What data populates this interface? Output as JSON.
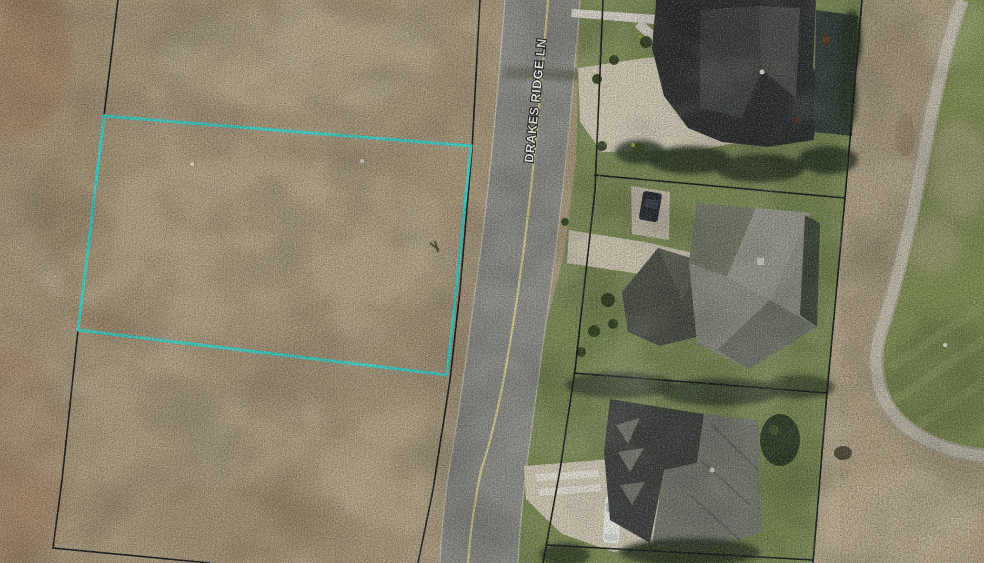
{
  "map": {
    "type": "aerial-parcel-imagery",
    "road_label": "DRAKES RIDGE LN",
    "highlighted_parcel": {
      "points": "104,116 471,146 447,375 78,330",
      "outline_color": "#3ed9cf"
    },
    "colors": {
      "highlight": "#3ed9cf",
      "parcel_line": "#161616",
      "bare_dirt": "#ab9b7d",
      "lawn_green": "#7b8b54",
      "rough_ground": "#b3a588",
      "golf_green": "#7d8d51",
      "cart_path": "#c3bead",
      "road_surface": "#8f908b",
      "road_centerline": "#ddd593",
      "roof_dark": "#2b2d2d",
      "roof_light": "#8e8e85",
      "driveway_concrete": "#d3ccb7",
      "label_text": "#fbfbf8"
    }
  }
}
